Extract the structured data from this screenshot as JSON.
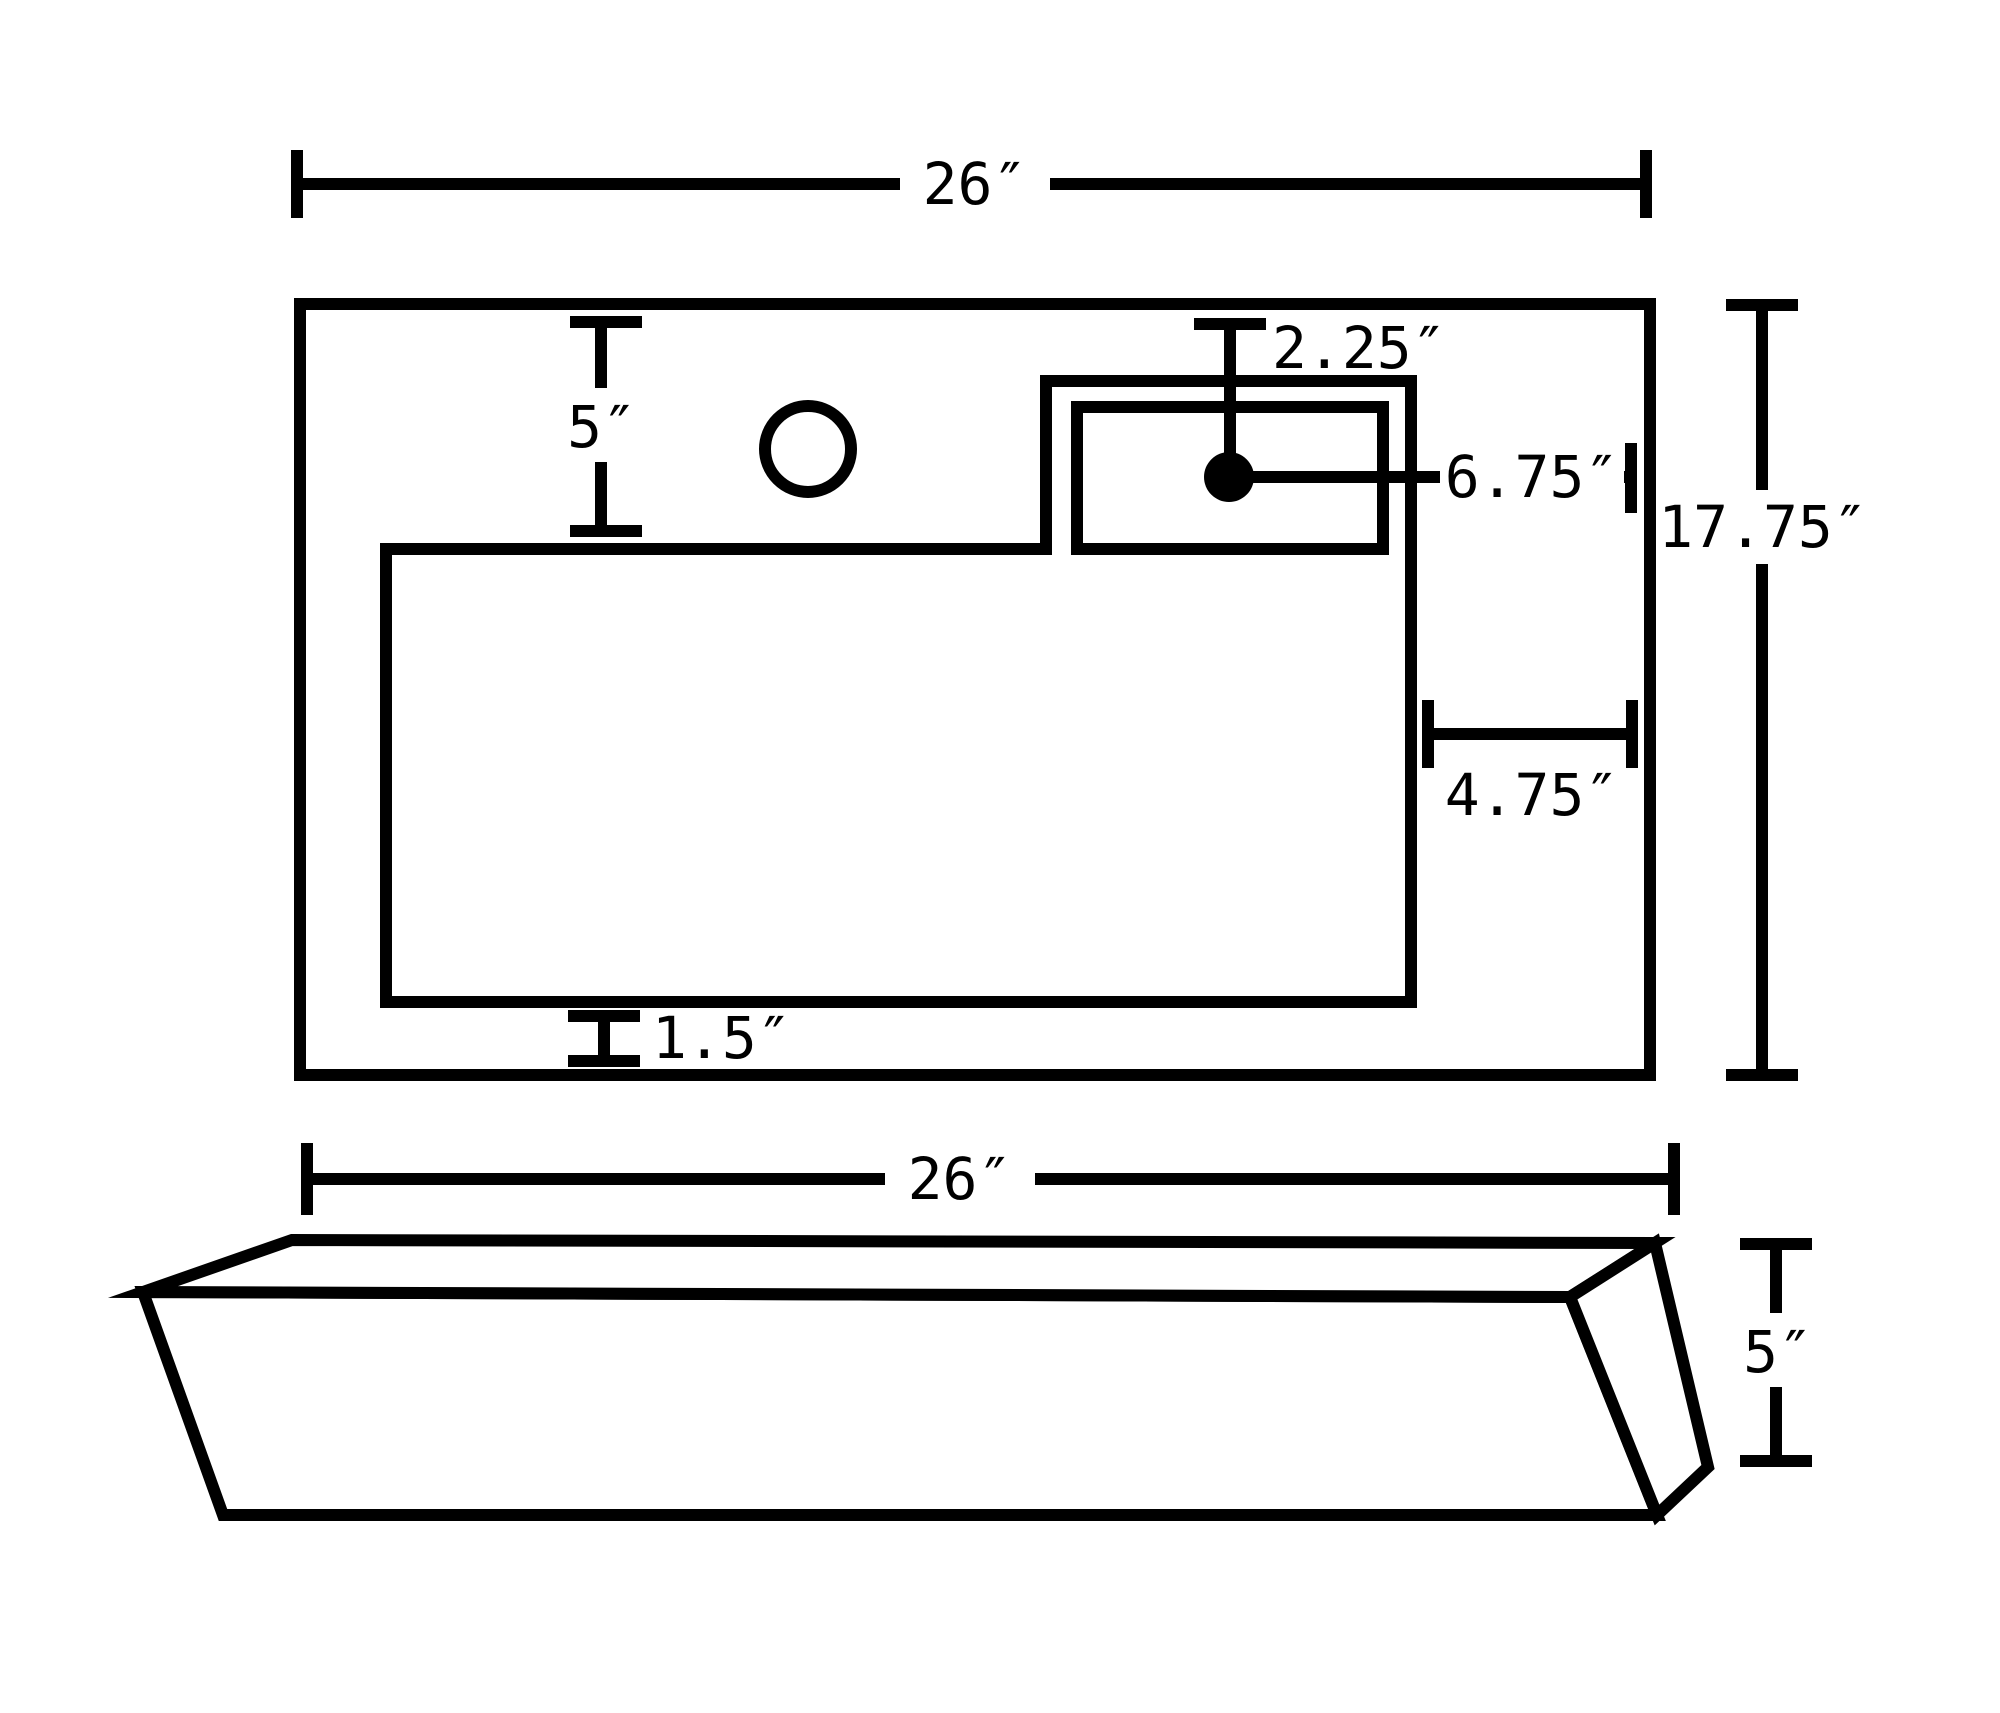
{
  "diagram": {
    "kind": "technical-dimension-drawing",
    "subject": "rectangular-sink",
    "colors": {
      "line": "#000000",
      "background": "#ffffff"
    },
    "top_view": {
      "overall_width_label": "26″",
      "overall_depth_label": "17.75″",
      "left_gap_label": "5″",
      "hole_from_top_label": "2.25″",
      "hole_from_right_label": "6.75″",
      "deck_width_label": "4.75″",
      "basin_to_front_label": "1.5″"
    },
    "side_view": {
      "overall_width_label": "26″",
      "height_label": "5″"
    }
  }
}
